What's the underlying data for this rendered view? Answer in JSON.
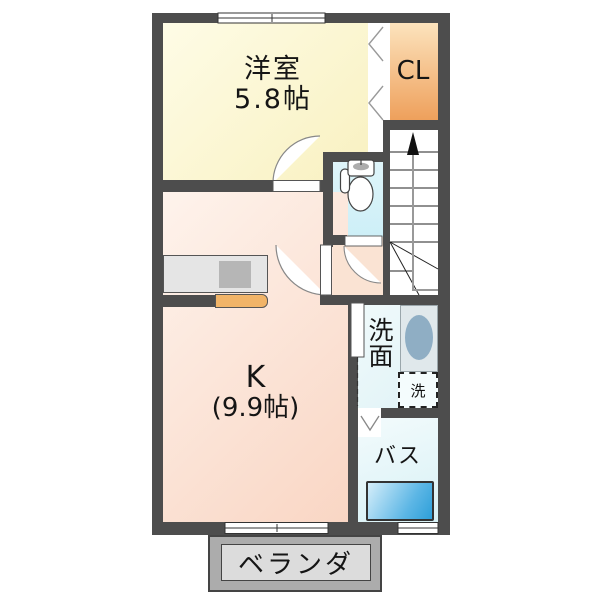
{
  "plan": {
    "title": "apartment-floorplan-1F",
    "western_room": {
      "name": "洋室",
      "size": "5.8帖"
    },
    "closet": {
      "label": "CL"
    },
    "kitchen": {
      "name": "K",
      "size": "(9.9帖)"
    },
    "washroom": {
      "label": "洗面"
    },
    "washing_machine": {
      "label": "洗"
    },
    "bath": {
      "label": "バス"
    },
    "veranda": {
      "label": "ベランダ"
    },
    "icons": {
      "stairs_up_arrow": "up-arrow",
      "toilet": "toilet-plan-symbol",
      "closet_folding_door": "double-chevron",
      "bath_folding_door": "chevron-down",
      "swing_doors": "quarter-arc",
      "sliding_windows": "double-line-window"
    },
    "colors": {
      "wall": "#4D4D4D",
      "western_room": "#F8F0BE",
      "closet_top": "#FCE3BD",
      "closet_bottom": "#EEA05C",
      "toilet": "#D5F1F8",
      "kitchen": "#F9D6C4",
      "washroom": "#E9F7F9",
      "bath": "#E3F5F8",
      "bathtub": "#2FA3DE",
      "sink_basin": "#8FAEC4",
      "kitchen_counter": "#E5E5E5",
      "kitchen_cabinet": "#F1B468",
      "veranda": "#ACACAC"
    }
  }
}
